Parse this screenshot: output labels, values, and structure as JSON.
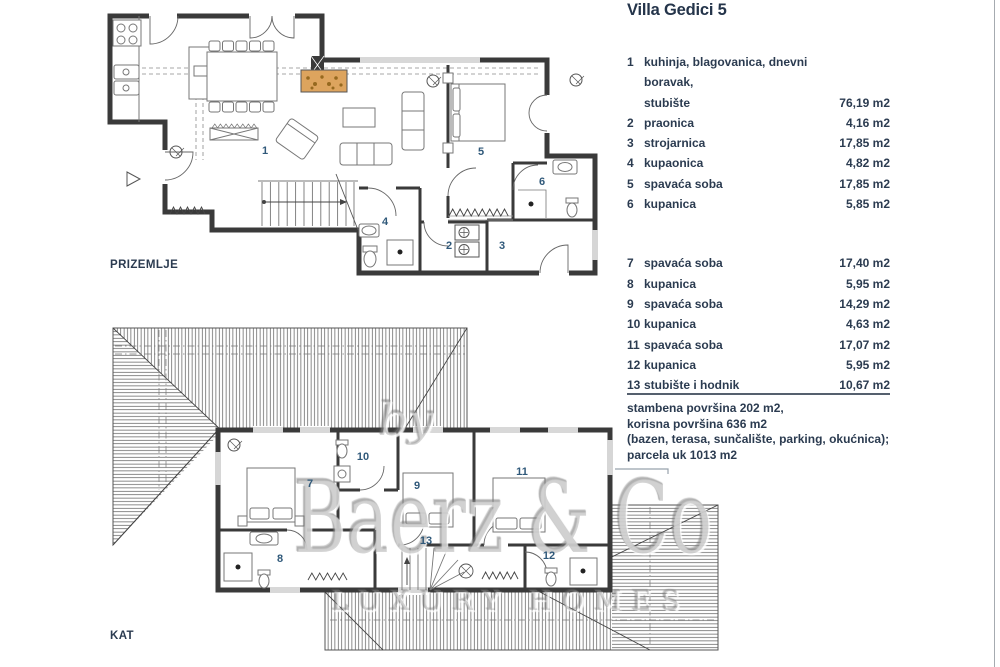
{
  "title": "Villa Gedici 5",
  "legend": {
    "rows": [
      {
        "no": "1",
        "label": "kuhinja, blagovanica, dnevni boravak,\nstubište",
        "area": "76,19 m2"
      },
      {
        "no": "2",
        "label": "praonica",
        "area": "4,16 m2"
      },
      {
        "no": "3",
        "label": "strojarnica",
        "area": "17,85 m2"
      },
      {
        "no": "4",
        "label": "kupaonica",
        "area": "4,82 m2"
      },
      {
        "no": "5",
        "label": "spavaća soba",
        "area": "17,85 m2"
      },
      {
        "no": "6",
        "label": "kupanica",
        "area": "5,85 m2"
      },
      {
        "no": "7",
        "label": "spavaća soba",
        "area": "17,40 m2"
      },
      {
        "no": "8",
        "label": "kupanica",
        "area": "5,95 m2"
      },
      {
        "no": "9",
        "label": "spavaća soba",
        "area": "14,29 m2"
      },
      {
        "no": "10",
        "label": "kupanica",
        "area": "4,63 m2"
      },
      {
        "no": "11",
        "label": "spavaća soba",
        "area": "17,07 m2"
      },
      {
        "no": "12",
        "label": "kupanica",
        "area": "5,95 m2"
      },
      {
        "no": "13",
        "label": "stubište i hodnik",
        "area": "10,67 m2"
      }
    ]
  },
  "summary": {
    "lines": [
      "stambena površina 202 m2,",
      "korisna površina 636 m2",
      "(bazen, terasa, sunčalište, parking, okućnica);",
      "parcela uk 1013 m2"
    ]
  },
  "plans": {
    "prizemlje": {
      "label": "PRIZEMLJE",
      "rooms": [
        "1",
        "2",
        "3",
        "4",
        "5",
        "6"
      ]
    },
    "kat": {
      "label": "KAT",
      "rooms": [
        "7",
        "8",
        "9",
        "10",
        "11",
        "12",
        "13"
      ]
    }
  },
  "watermark": {
    "by": "by",
    "name": "Baerz & Co",
    "tagline": "LUXURY HOMES"
  },
  "colors": {
    "text": "#2b3b50",
    "room_number": "#30597a",
    "wall": "#3a3a3a",
    "fireplace": "#dda45e",
    "separator": "#55606e",
    "watermark": "#8c8c8c"
  }
}
